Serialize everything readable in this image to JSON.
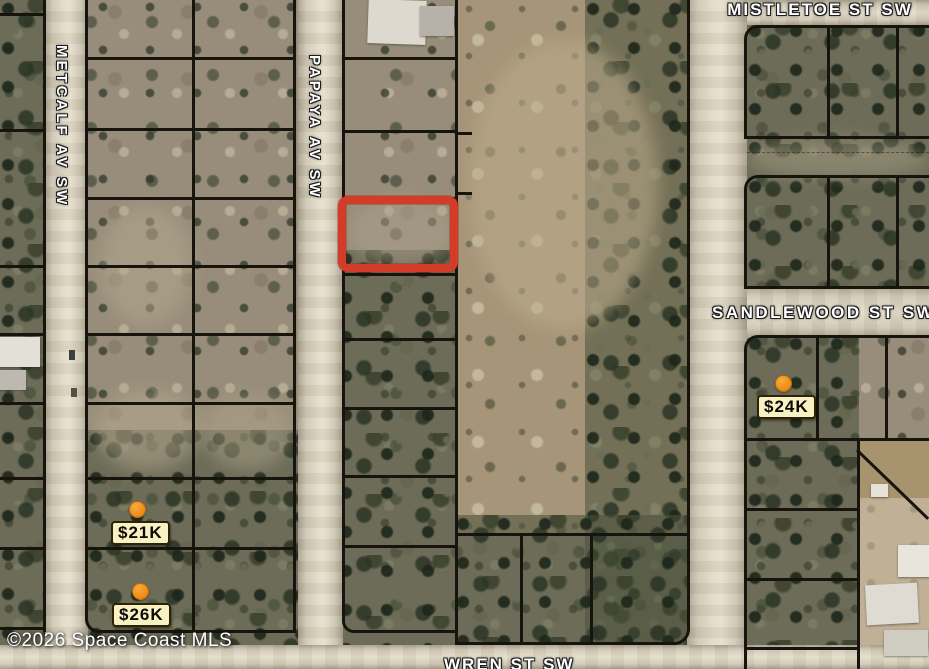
{
  "map": {
    "streets": {
      "metcalf": "METCALF AV SW",
      "papaya": "PAPAYA AV SW",
      "mistletoe": "MISTLETOE ST SW",
      "sandlewood": "SANDLEWOOD ST SW",
      "wren": "WREN ST SW"
    },
    "price_markers": [
      {
        "id": "21k",
        "label": "$21K"
      },
      {
        "id": "26k",
        "label": "$26K"
      },
      {
        "id": "24k",
        "label": "$24K"
      }
    ],
    "highlighted_parcel": {
      "outline_color": "#d23c28"
    },
    "marker_style": {
      "dot_color": "#ef8d14",
      "label_bg": "#f8f1c4"
    },
    "copyright": "©2026 Space Coast MLS"
  }
}
